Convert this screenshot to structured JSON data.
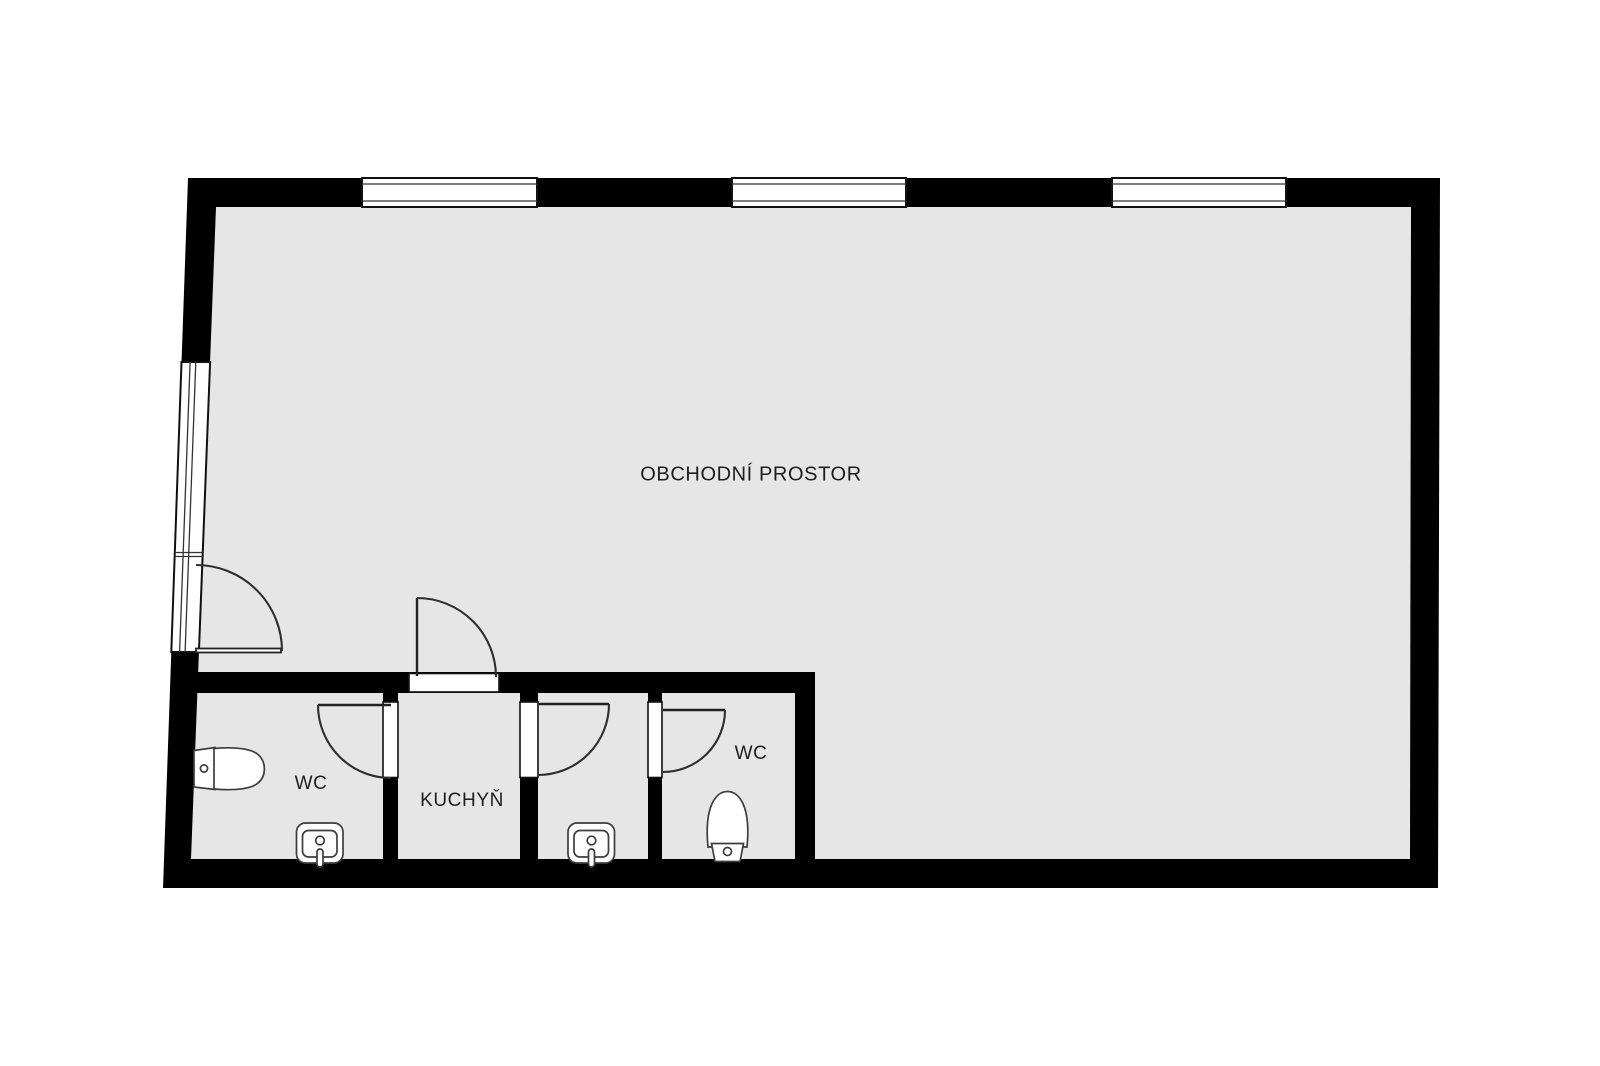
{
  "floorplan": {
    "rooms": [
      {
        "name": "obchodni-prostor",
        "label": "OBCHODNÍ PROSTOR"
      },
      {
        "name": "wc-left",
        "label": "WC"
      },
      {
        "name": "kuchyn",
        "label": "KUCHYŇ"
      },
      {
        "name": "wc-right",
        "label": "WC"
      }
    ],
    "fixtures": [
      "toilet-icon",
      "sink-icon",
      "sink-icon",
      "toilet-icon"
    ],
    "windows": {
      "top_wall_count": 3,
      "left_wall_count": 1
    },
    "door_count": 5,
    "colors": {
      "wall": "#000000",
      "floor": "#e6e6e6",
      "door-stroke": "#2e2e2e",
      "fixture-stroke": "#3d3d3d",
      "label": "#1e1e1e",
      "background": "#ffffff"
    }
  }
}
